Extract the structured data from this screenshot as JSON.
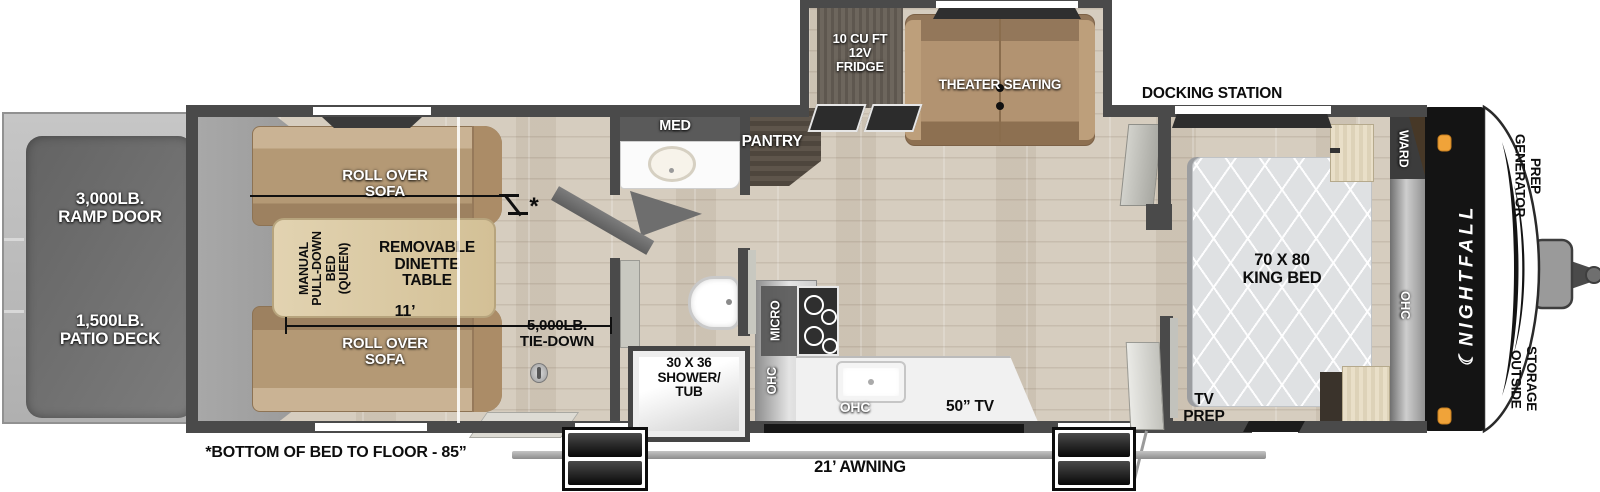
{
  "colors": {
    "wall": "#4a4a4a",
    "floor_wood": "#d6cdbf",
    "garage_floor": "#a0a0a0",
    "sofa_tan": "#b49975",
    "dinette_table": "#d9c8a4",
    "dark_wood": "#58514a",
    "counter_white": "#f2f2f2",
    "front_panel_black": "#141414",
    "marker_light_orange": "#f0a339",
    "mattress_gray": "#dfe1e3"
  },
  "rear": {
    "ramp_door_label": "3,000LB.\nRAMP DOOR",
    "patio_deck_label": "1,500LB.\nPATIO DECK"
  },
  "garage": {
    "sofa_top_label": "ROLL OVER\nSOFA",
    "sofa_bottom_label": "ROLL OVER\nSOFA",
    "pulldown_bed_label": "MANUAL\nPULL-DOWN\nBED\n(QUEEN)",
    "dinette_label": "REMOVABLE\nDINETTE\nTABLE",
    "length_label": "11’",
    "tie_down_label": "5,000LB.\nTIE-DOWN",
    "asterisk": "*",
    "bed_note": "*BOTTOM OF BED TO FLOOR - 85”"
  },
  "bath": {
    "med_label": "MED",
    "shower_label": "30 X 36\nSHOWER/\nTUB"
  },
  "kitchen": {
    "pantry_label": "PANTRY",
    "fridge_label": "10 CU FT\n12V\nFRIDGE",
    "theater_label": "THEATER SEATING",
    "micro_label": "MICRO",
    "ohc_upper_label": "OHC",
    "ohc_counter_label": "OHC",
    "tv_label": "50” TV"
  },
  "bedroom": {
    "docking_label": "DOCKING STATION",
    "ward_label": "WARD",
    "bed_label": "70 X 80\nKING BED",
    "ohc_label": "OHC",
    "tv_prep_label": "TV\nPREP"
  },
  "front": {
    "brand": "NIGHTFALL",
    "crescent": "☾",
    "generator_label": "GENERATOR\nPREP",
    "outside_label": "OUTSIDE\nSTORAGE"
  },
  "exterior": {
    "awning_label": "21’ AWNING"
  }
}
